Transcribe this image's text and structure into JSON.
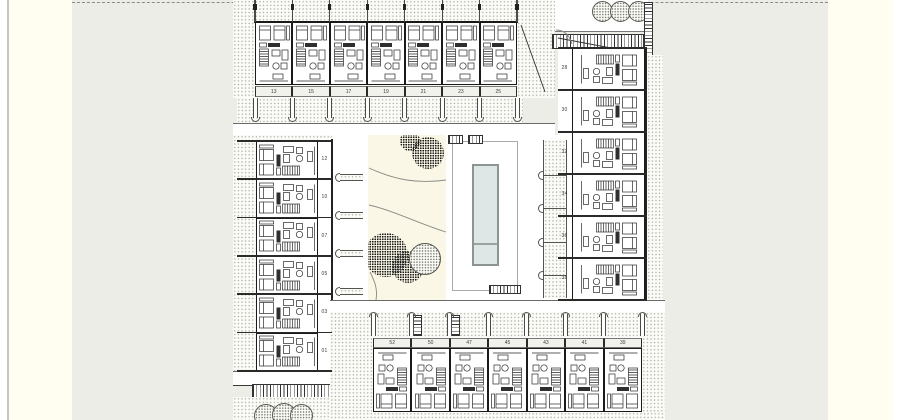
{
  "meta": {
    "title": "Residential complex site plan — ground floor with courtyard pool",
    "sheet_type": "architectural plan drawing"
  },
  "units": {
    "top_row": [
      "13",
      "15",
      "17",
      "19",
      "21",
      "23",
      "25"
    ],
    "left_column": [
      "12",
      "10",
      "07",
      "05",
      "03",
      "01"
    ],
    "right_column": [
      "28",
      "30",
      "32",
      "34",
      "36",
      "38"
    ],
    "bottom_row": [
      "52",
      "50",
      "47",
      "45",
      "43",
      "41",
      "39"
    ]
  },
  "features": {
    "pool_label": "courtyard pool",
    "garden_label": "landscaped courtyard",
    "top_tree_count": 3,
    "bottom_tree_count": 3,
    "garden_tree_count": 5
  },
  "colors": {
    "sheet": "#FFFEF0",
    "canvas": "#ECEDE7",
    "garden": "#FAF7E6",
    "pool_water": "#DEE7E5",
    "pool_frame": "#8C9494",
    "wall": "#1A1A1A",
    "boundary_dash": "#8B8B85"
  }
}
